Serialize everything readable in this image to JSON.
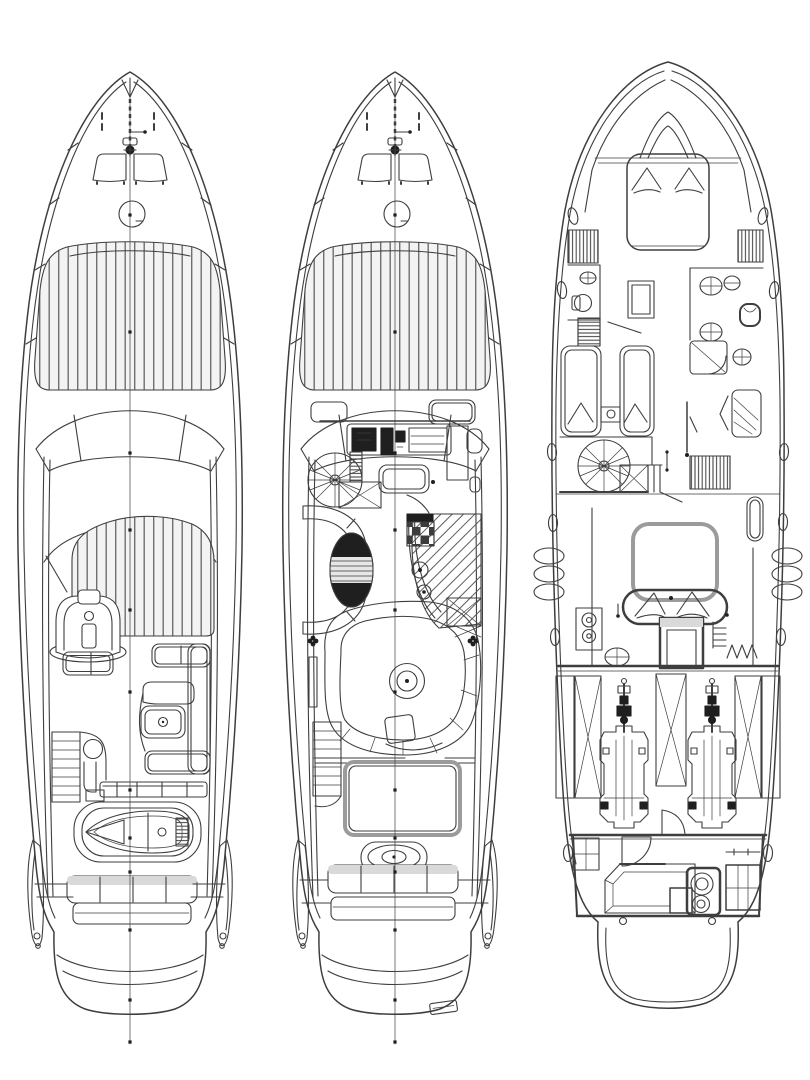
{
  "page": {
    "background": "#ffffff",
    "colors": {
      "ink": "#3e3e3e",
      "ink-heavy": "#1f1f1f",
      "ink-soft": "#9b9b9b",
      "band": "#d9d9d9"
    }
  },
  "figure": {
    "type": "yacht-deck-plans",
    "orientation": "bow-up",
    "views": [
      {
        "id": "flybridge-deck",
        "label": "Flybridge and foredeck plan",
        "features": [
          "bow-pulpit",
          "anchor-windlass",
          "mooring-cleats",
          "foredeck-hatch",
          "deck-circle",
          "foredeck-sunpad",
          "windshield",
          "flybridge-sunpad",
          "helm-seat",
          "companion-bench",
          "l-shaped-settee",
          "cockpit-table",
          "ladder-stairs",
          "wet-bar",
          "tender-on-garage",
          "aft-bench",
          "swim-platform",
          "centerline"
        ]
      },
      {
        "id": "main-deck",
        "label": "Main deck plan",
        "features": [
          "bow-pulpit",
          "anchor-windlass",
          "mooring-cleats",
          "foredeck-hatch",
          "deck-circle",
          "foredeck-sunpad",
          "windshield",
          "helm-console",
          "side-seat",
          "spiral-staircase",
          "helm-bench",
          "curved-settee",
          "oval-table",
          "galley-with-hatched-floor",
          "stove",
          "sinks",
          "dinette-booth",
          "round-table",
          "companionway-stairs",
          "cockpit-hatch",
          "table-pedestal",
          "aft-bench",
          "swim-platform",
          "platform-hatch",
          "centerline"
        ]
      },
      {
        "id": "lower-deck",
        "label": "Lower deck and engine room plan",
        "features": [
          "vip-cabin-double-bed",
          "pillows",
          "wardrobes",
          "portholes",
          "fenders",
          "tv-cabinet",
          "guest-cabin-twin-berths",
          "nightstand",
          "head-with-shower",
          "toilet",
          "sinks",
          "spiral-staircase",
          "storage-louvers",
          "master-cabin-double-bed",
          "washer-stack",
          "companionway-door",
          "engine-room",
          "twin-engines",
          "propeller-shafts",
          "structural-x-braces",
          "aft-crew-cabin",
          "crew-berth",
          "wc-unit",
          "cabinet",
          "swim-platform"
        ]
      }
    ]
  }
}
